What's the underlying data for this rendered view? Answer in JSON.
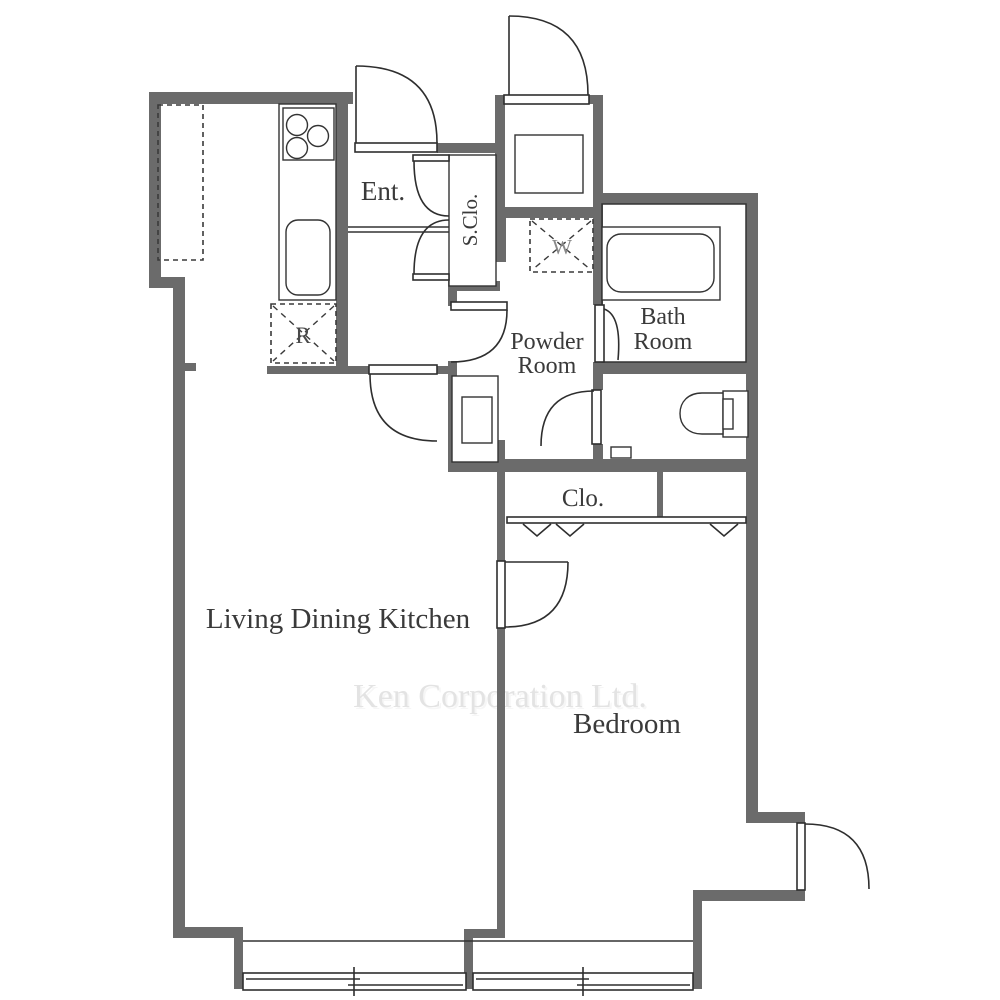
{
  "watermark": {
    "text": "Ken Corporation Ltd."
  },
  "rooms": {
    "entrance": {
      "label": "Ent."
    },
    "shoe_closet": {
      "label": "S.Clo."
    },
    "powder_room": {
      "label_line1": "Powder",
      "label_line2": "Room"
    },
    "bath_room": {
      "label_line1": "Bath",
      "label_line2": "Room"
    },
    "closet": {
      "label": "Clo."
    },
    "living_dining_kitchen": {
      "label": "Living Dining Kitchen"
    },
    "bedroom": {
      "label": "Bedroom"
    }
  },
  "appliances": {
    "washing_machine": {
      "label": "W"
    },
    "refrigerator": {
      "label": "R"
    }
  },
  "colors": {
    "wall": "#6b6b6b",
    "line": "#333333",
    "text": "#3a3a3a",
    "watermark": "#e3e3e3"
  }
}
